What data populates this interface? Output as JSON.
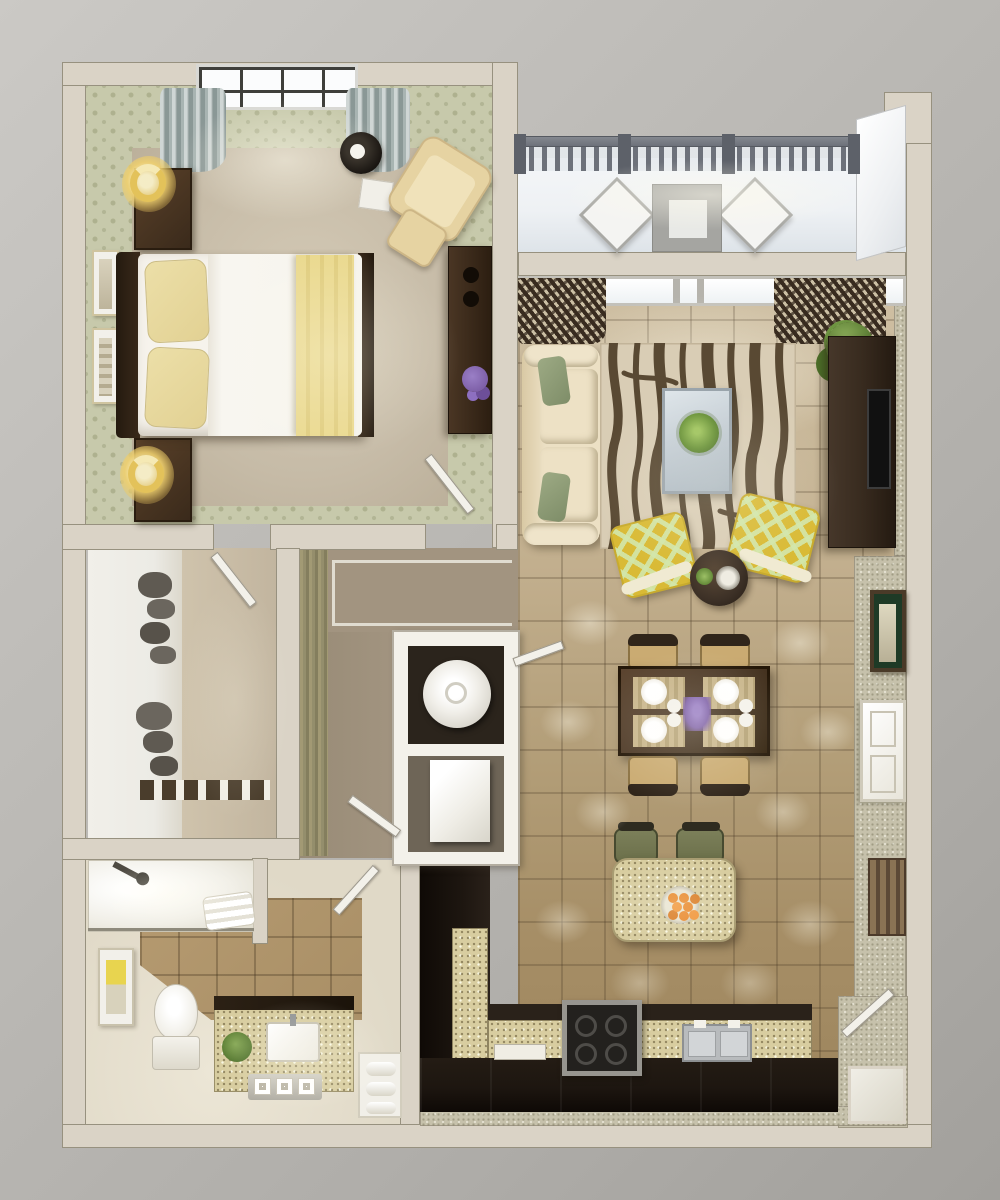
{
  "scene": {
    "type": "3d-rendered-floor-plan",
    "view": "top-down",
    "subject": "one-bedroom apartment with balcony",
    "visible_text": []
  },
  "colors": {
    "bg1": "#cbc9c5",
    "bg2": "#b0aeaa",
    "bg3": "#a2a09c",
    "wall": "#dad3c6",
    "walledge": "#97917f",
    "white": "#f3f1ea",
    "wallpaper": "#c7c9ab",
    "wallpaperdot": "#aeb18f",
    "carpet": "#c6bba7",
    "curtain": "#a8b4b2",
    "darkwood": "#3a2a1b",
    "lampglow": "#eed77c",
    "bedwhite": "#f6f3ec",
    "pillow": "#e2d193",
    "cream": "#e6d3a2",
    "balconyfloor": "#eef1f4",
    "railing": "#6d717a",
    "tilelight": "#cfc0a4",
    "tiledark": "#9c845c",
    "rugbase": "#d9cdb5",
    "rugstripe": "#594933",
    "glass": "#c5ced5",
    "green": "#5d7a3a",
    "console": "#382b1f",
    "tv": "#111111",
    "ikat1": "#d9ba35",
    "tabledark": "#3c3026",
    "diningwood": "#4b3826",
    "placemat": "#c9b68c",
    "plate": "#f3f0e9",
    "purple": "#7e60a8",
    "granite": "#d8cda0",
    "counterdark": "#1d1610",
    "steel": "#b8bbbd",
    "orange": "#e8872a",
    "stool": "#6b6f4a",
    "bathtile": "#a98f66",
    "bathfloor": "#e0d9c7",
    "texwall": "#c6c1ab",
    "olive": "#948e6b",
    "hallfloor": "#a29480",
    "clothes": "#5f5a52",
    "closetwhite": "#ecebe5",
    "closettan": "#c2b59f",
    "slat1": "#8a7354",
    "slat2": "#5c4936"
  },
  "rooms": {
    "bedroom": {
      "furniture": [
        "double-bed",
        "headboard",
        "pillow",
        "pillow",
        "duvet",
        "throw-blanket",
        "nightstand",
        "nightstand",
        "table-lamp",
        "table-lamp",
        "framed-art",
        "framed-art",
        "window",
        "curtain",
        "curtain",
        "floor-lamp",
        "floor-mat",
        "armchair",
        "ottoman",
        "dresser",
        "flower-vase",
        "door"
      ]
    },
    "balcony": {
      "furniture": [
        "railing",
        "patio-chair",
        "patio-chair",
        "patio-table"
      ]
    },
    "living_room": {
      "furniture": [
        "window",
        "curtain",
        "curtain",
        "sofa",
        "throw-pillow",
        "throw-pillow",
        "zebra-rug",
        "glass-coffee-table",
        "succulent-plant",
        "potted-plant",
        "tv-console",
        "tv",
        "accent-chair",
        "accent-chair",
        "round-side-table",
        "candles",
        "framed-art"
      ]
    },
    "dining_area": {
      "furniture": [
        "dining-table",
        "dining-chair",
        "dining-chair",
        "dining-chair",
        "dining-chair",
        "placemat",
        "placemat",
        "placemat",
        "placemat",
        "plates",
        "flower-centerpiece"
      ]
    },
    "kitchen": {
      "furniture": [
        "island",
        "bar-stool",
        "bar-stool",
        "fruit-bowl-oranges",
        "l-shaped-counter",
        "stove",
        "double-sink",
        "cutting-board",
        "wall-panel",
        "louvered-panel",
        "entry-door"
      ]
    },
    "laundry_closet": {
      "furniture": [
        "washer",
        "dryer",
        "door"
      ]
    },
    "walk_in_closet": {
      "furniture": [
        "hanging-clothes",
        "hanging-clothes",
        "shelf-rail",
        "door"
      ]
    },
    "hallway": {
      "furniture": []
    },
    "bathroom": {
      "furniture": [
        "bathtub-shower",
        "shower-head",
        "glass-partition",
        "towels",
        "toilet",
        "vanity",
        "sink",
        "plant",
        "toiletry-tray",
        "framed-art",
        "linen-niche",
        "door"
      ]
    }
  }
}
